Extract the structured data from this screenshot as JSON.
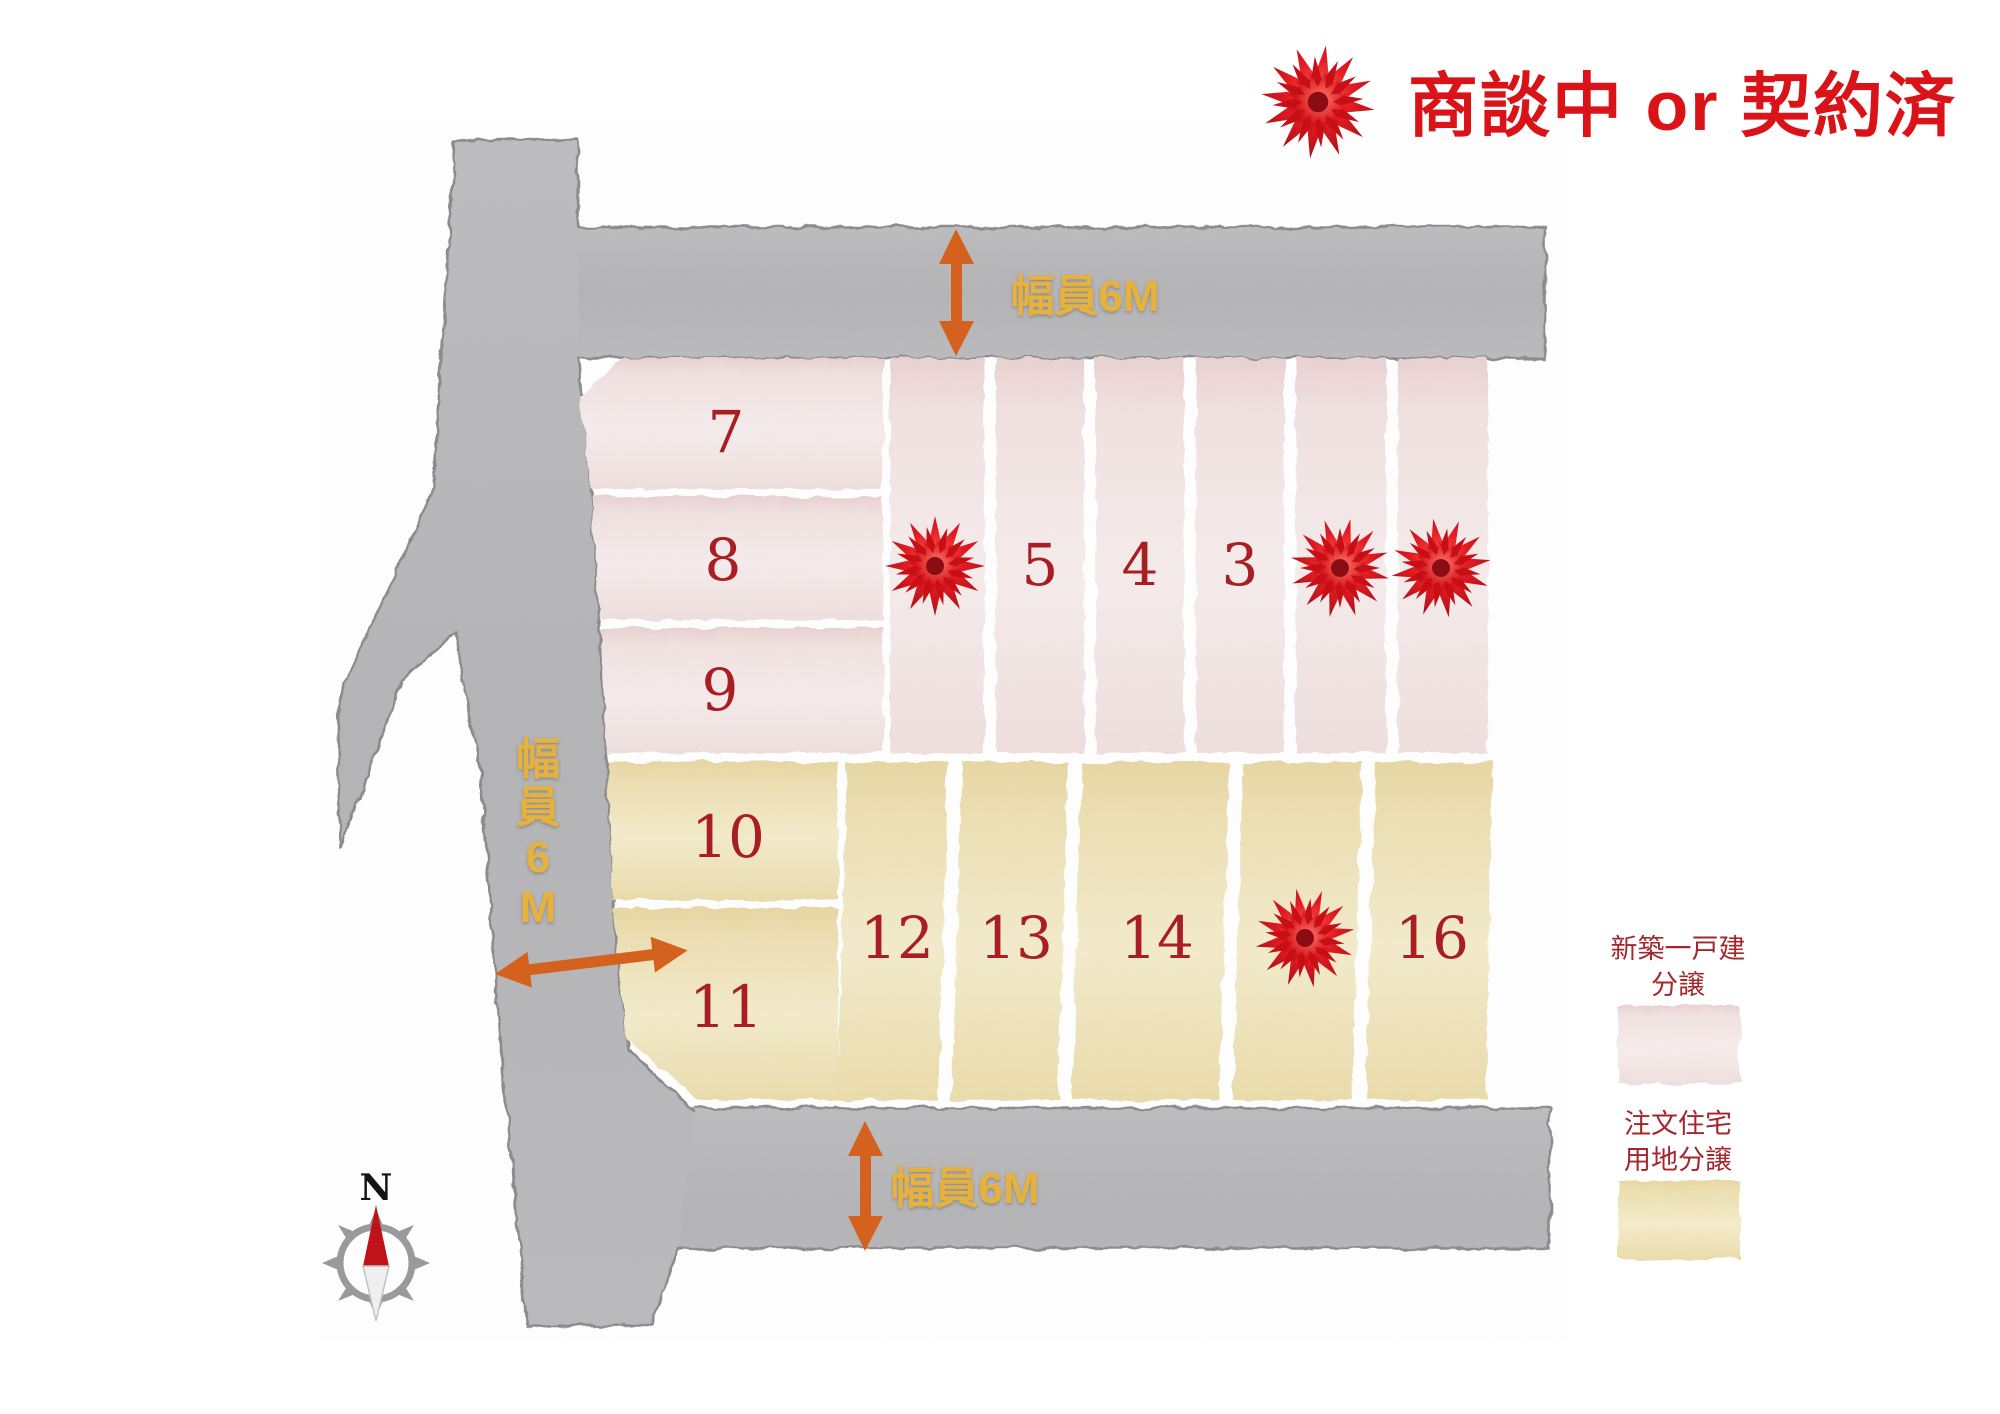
{
  "header": {
    "status_label": "商談中 or 契約済",
    "status_color": "#da1318"
  },
  "road_labels": {
    "top": "幅員6M",
    "bottom": "幅員6M",
    "left_chars": [
      "幅",
      "員",
      "6",
      "M"
    ],
    "label_color": "#e6b23c",
    "arrow_color": "#d4611e"
  },
  "compass": {
    "north_label": "N"
  },
  "legend": {
    "items": [
      {
        "line1": "新築一戸建",
        "line2": "分譲",
        "swatch_color": "#f2e5e4"
      },
      {
        "line1": "注文住宅",
        "line2": "用地分譲",
        "swatch_color": "#ecdfb2"
      }
    ]
  },
  "lots": [
    {
      "id": "lot-1",
      "label": "",
      "block": "pink",
      "bow": true
    },
    {
      "id": "lot-2",
      "label": "",
      "block": "pink",
      "bow": true
    },
    {
      "id": "lot-3",
      "label": "3",
      "block": "pink",
      "bow": false
    },
    {
      "id": "lot-4",
      "label": "4",
      "block": "pink",
      "bow": false
    },
    {
      "id": "lot-5",
      "label": "5",
      "block": "pink",
      "bow": false
    },
    {
      "id": "lot-6",
      "label": "",
      "block": "pink",
      "bow": true
    },
    {
      "id": "lot-7",
      "label": "7",
      "block": "pink",
      "bow": false
    },
    {
      "id": "lot-8",
      "label": "8",
      "block": "pink",
      "bow": false
    },
    {
      "id": "lot-9",
      "label": "9",
      "block": "pink",
      "bow": false
    },
    {
      "id": "lot-10",
      "label": "10",
      "block": "yellow",
      "bow": false
    },
    {
      "id": "lot-11",
      "label": "11",
      "block": "yellow",
      "bow": false
    },
    {
      "id": "lot-12",
      "label": "12",
      "block": "yellow",
      "bow": false
    },
    {
      "id": "lot-13",
      "label": "13",
      "block": "yellow",
      "bow": false
    },
    {
      "id": "lot-14",
      "label": "14",
      "block": "yellow",
      "bow": false
    },
    {
      "id": "lot-15",
      "label": "",
      "block": "yellow",
      "bow": true
    },
    {
      "id": "lot-16",
      "label": "16",
      "block": "yellow",
      "bow": false
    }
  ],
  "colors": {
    "road_gray": "#b7b7b9",
    "road_edge": "#8b8b8d",
    "pink_lot": "#f2e5e4",
    "yellow_lot": "#ecdfb2",
    "lot_number_red": "#a81e23",
    "legend_text_red": "#a6272b",
    "bow_red": "#d5131a"
  }
}
